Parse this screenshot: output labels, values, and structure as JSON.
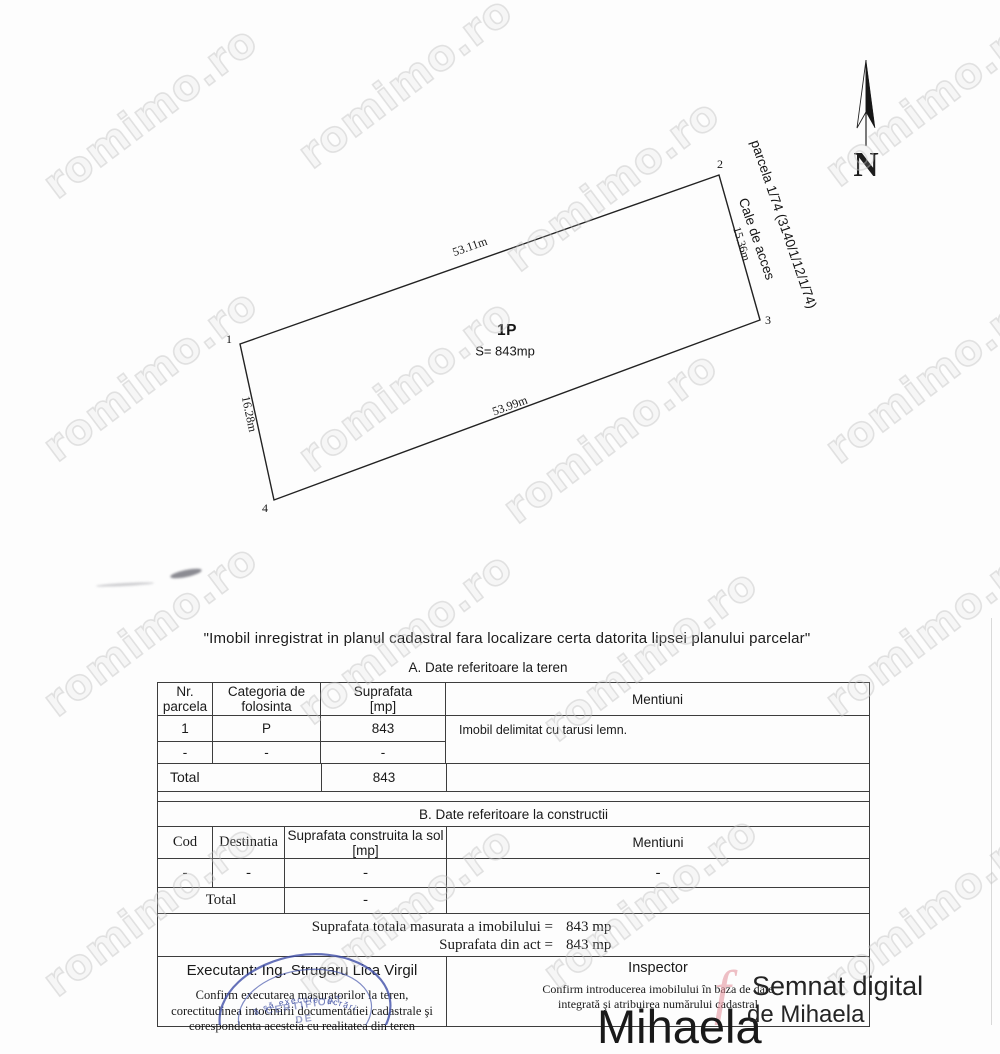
{
  "watermark": {
    "text": "romimo.ro"
  },
  "plan": {
    "north_label": "N",
    "parcel_number": "1P",
    "parcel_area": "S= 843mp",
    "vertex_labels": [
      "1",
      "2",
      "3",
      "4"
    ],
    "dim_top": "53.11m",
    "dim_right": "15.36m",
    "dim_bottom": "53.99m",
    "dim_left": "16.28m",
    "neighbor_parcel": "parcela 1/74 (3140/1/12/1/74)",
    "access_way": "Cale de acces"
  },
  "doc": {
    "title": "\"Imobil inregistrat in planul cadastral fara localizare certa datorita lipsei planului parcelar\""
  },
  "section_a": {
    "heading": "A. Date referitoare la teren",
    "h_nr_1": "Nr.",
    "h_nr_2": "parcela",
    "h_cat_1": "Categoria de",
    "h_cat_2": "folosinta",
    "h_sup_1": "Suprafata",
    "h_sup_2": "[mp]",
    "h_mentiuni": "Mentiuni",
    "r1_nr": "1",
    "r1_cat": "P",
    "r1_sup": "843",
    "r2_nr": "-",
    "r2_cat": "-",
    "r2_sup": "-",
    "mentiuni": "Imobil delimitat cu tarusi lemn.",
    "total_label": "Total",
    "total_sup": "843"
  },
  "section_b": {
    "heading": "B. Date referitoare la constructii",
    "h_cod": "Cod",
    "h_dest": "Destinatia",
    "h_sup_1": "Suprafata construita la sol",
    "h_sup_2": "[mp]",
    "h_mentiuni": "Mentiuni",
    "r1_cod": "-",
    "r1_dest": "-",
    "r1_sup": "-",
    "r1_mentiuni": "-",
    "total_label": "Total",
    "total_sup": "-"
  },
  "totals": {
    "measured_label": "Suprafata totala masurata a imobilului =",
    "measured_value": "843 mp",
    "act_label": "Suprafata din act =",
    "act_value": "843 mp"
  },
  "executant": {
    "name_line": "Executant: Ing. Strugaru Lica Virgil",
    "note_line1": "Confirm executarea masuratorilor la teren,",
    "note_line2": "corectitudinea intocmirii documentatiei cadastrale şi",
    "note_line3": "corespondenta acesteia cu realitatea din teren",
    "stamp_arc": "ă să execute lucrări",
    "stamp_line1": "CERTIFICAT",
    "stamp_line2": "DE"
  },
  "inspector": {
    "label": "Inspector",
    "note_line1": "Confirm introducerea imobilului în baza de date",
    "note_line2": "integrată şi atribuirea numărului cadastral",
    "sig_big_name": "Mihaela",
    "sig_line1": "Semnat digital",
    "sig_line2": "de Mihaela",
    "sig_red_mark": "f"
  },
  "colors": {
    "stamp_blue": "#3c4ba6",
    "signature_pink": "#e28c98",
    "watermark_gray": "#bebebe"
  }
}
